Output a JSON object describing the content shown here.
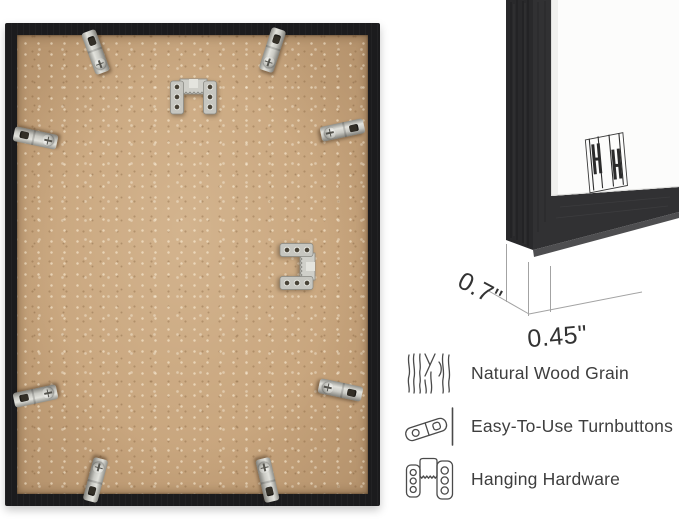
{
  "frame_back_photo": {
    "turnbutton_count": 8,
    "hanging_hardware_count": 2,
    "colors": {
      "frame_wood": "#1b1b1d",
      "mdf_backing": "#c7a47c",
      "metal_hardware": "#c6c6c0"
    }
  },
  "corner_detail": {
    "measurements": {
      "depth": "0.7\"",
      "face_width": "0.45\""
    },
    "logo_icon": "brand-hh-logo",
    "colors": {
      "molding_black": "#2e2e30",
      "mat_white": "#fcfcfb",
      "dimension_line": "#a3a3a3"
    }
  },
  "features": [
    {
      "icon": "wood-grain-icon",
      "label": "Natural Wood Grain"
    },
    {
      "icon": "turnbutton-icon",
      "label": "Easy-To-Use Turnbuttons"
    },
    {
      "icon": "hanging-hardware-icon",
      "label": "Hanging Hardware"
    }
  ],
  "text_color": "#3e3e3e"
}
